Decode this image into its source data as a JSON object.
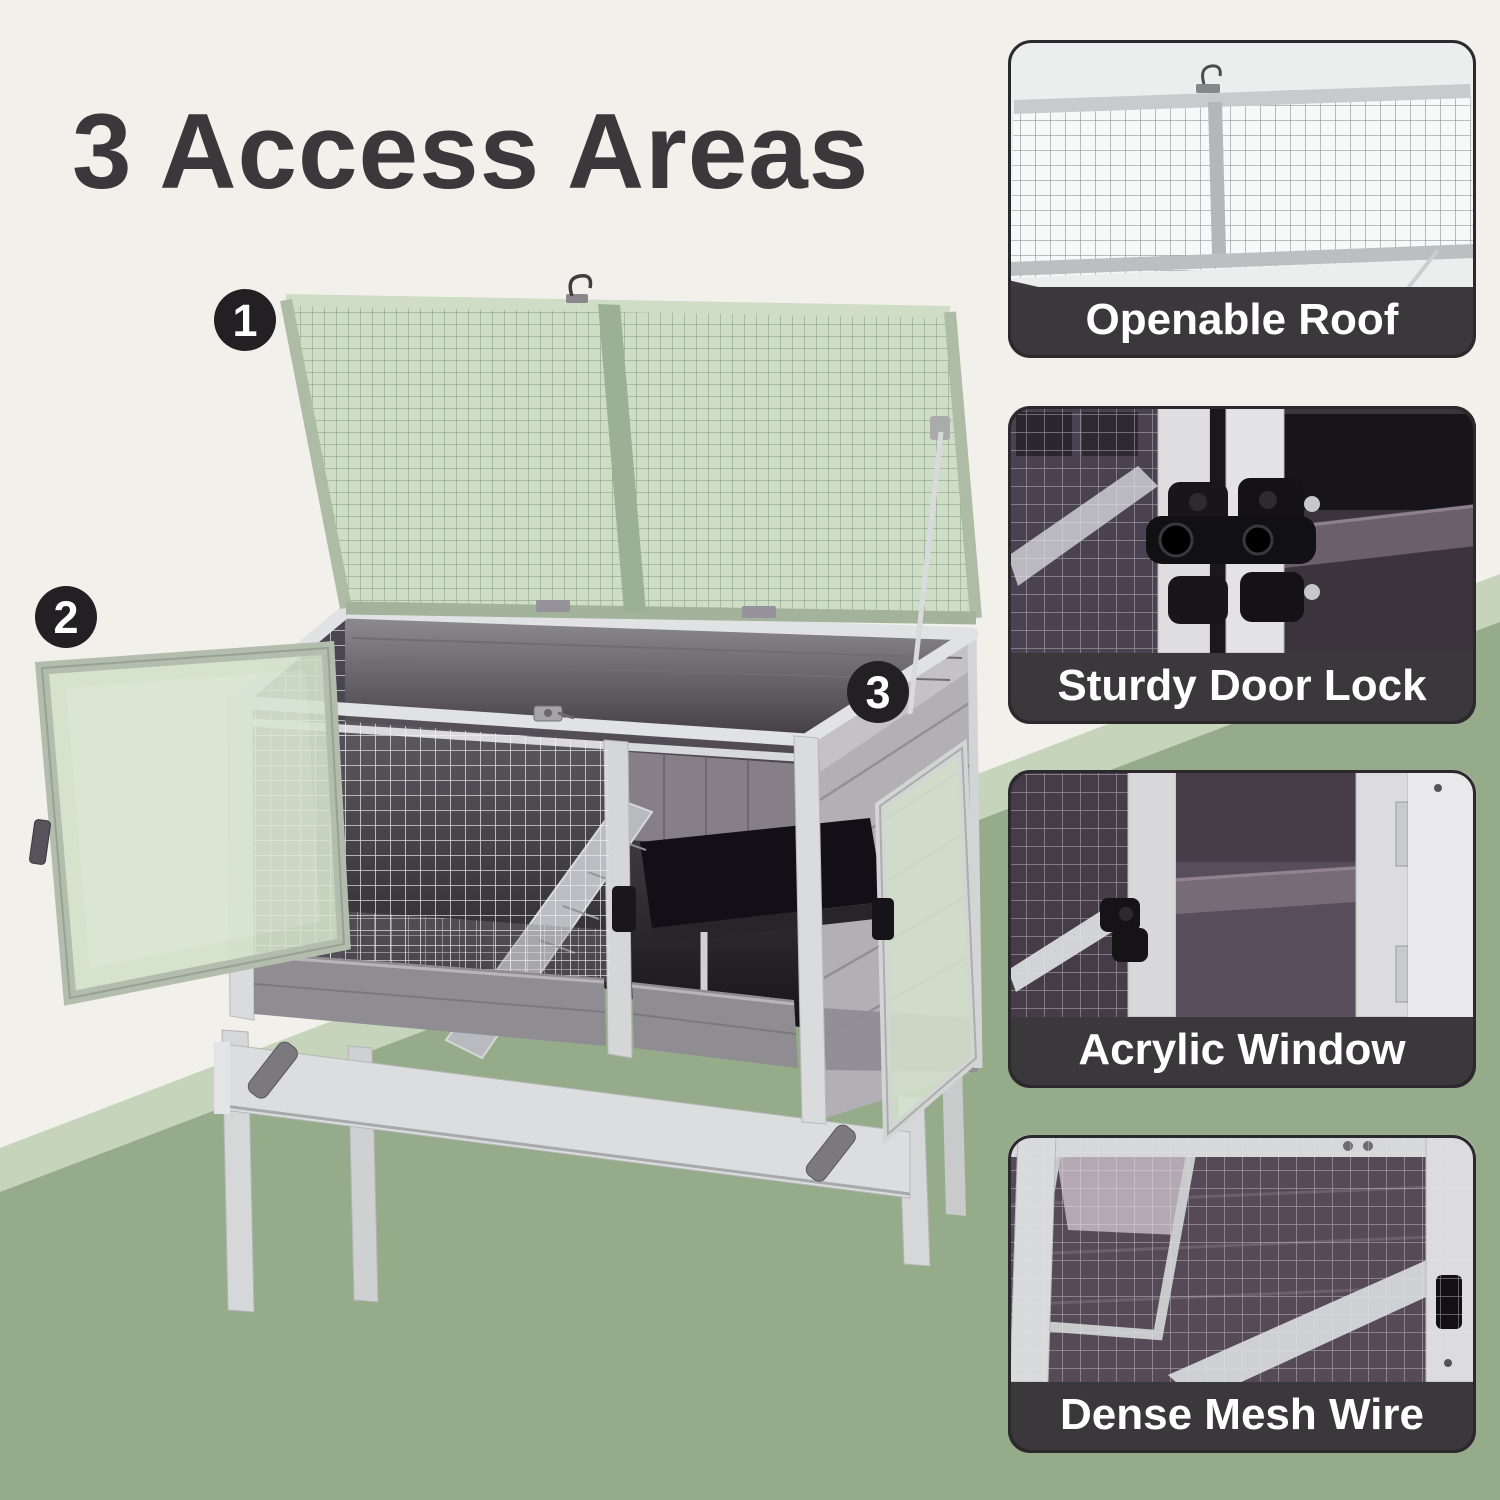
{
  "title": {
    "text": "3 Access Areas",
    "color": "#3a383b"
  },
  "badges": [
    "1",
    "2",
    "3"
  ],
  "panels": [
    {
      "label": "Openable Roof"
    },
    {
      "label": "Sturdy Door Lock"
    },
    {
      "label": "Acrylic Window"
    },
    {
      "label": "Dense Mesh Wire"
    }
  ],
  "colors": {
    "background": "#f2f0ea",
    "band_light": "#c6d4bc",
    "band_green": "#95ab8a",
    "caption_bg": "#3a383a",
    "caption_text": "#ffffff",
    "badge_bg": "#222022",
    "badge_text": "#ffffff",
    "lid_mesh_green": "#c9dac2",
    "wood_light": "#dadbdd",
    "wood_gray": "#8f8c92",
    "interior_dark": "#17151a"
  }
}
